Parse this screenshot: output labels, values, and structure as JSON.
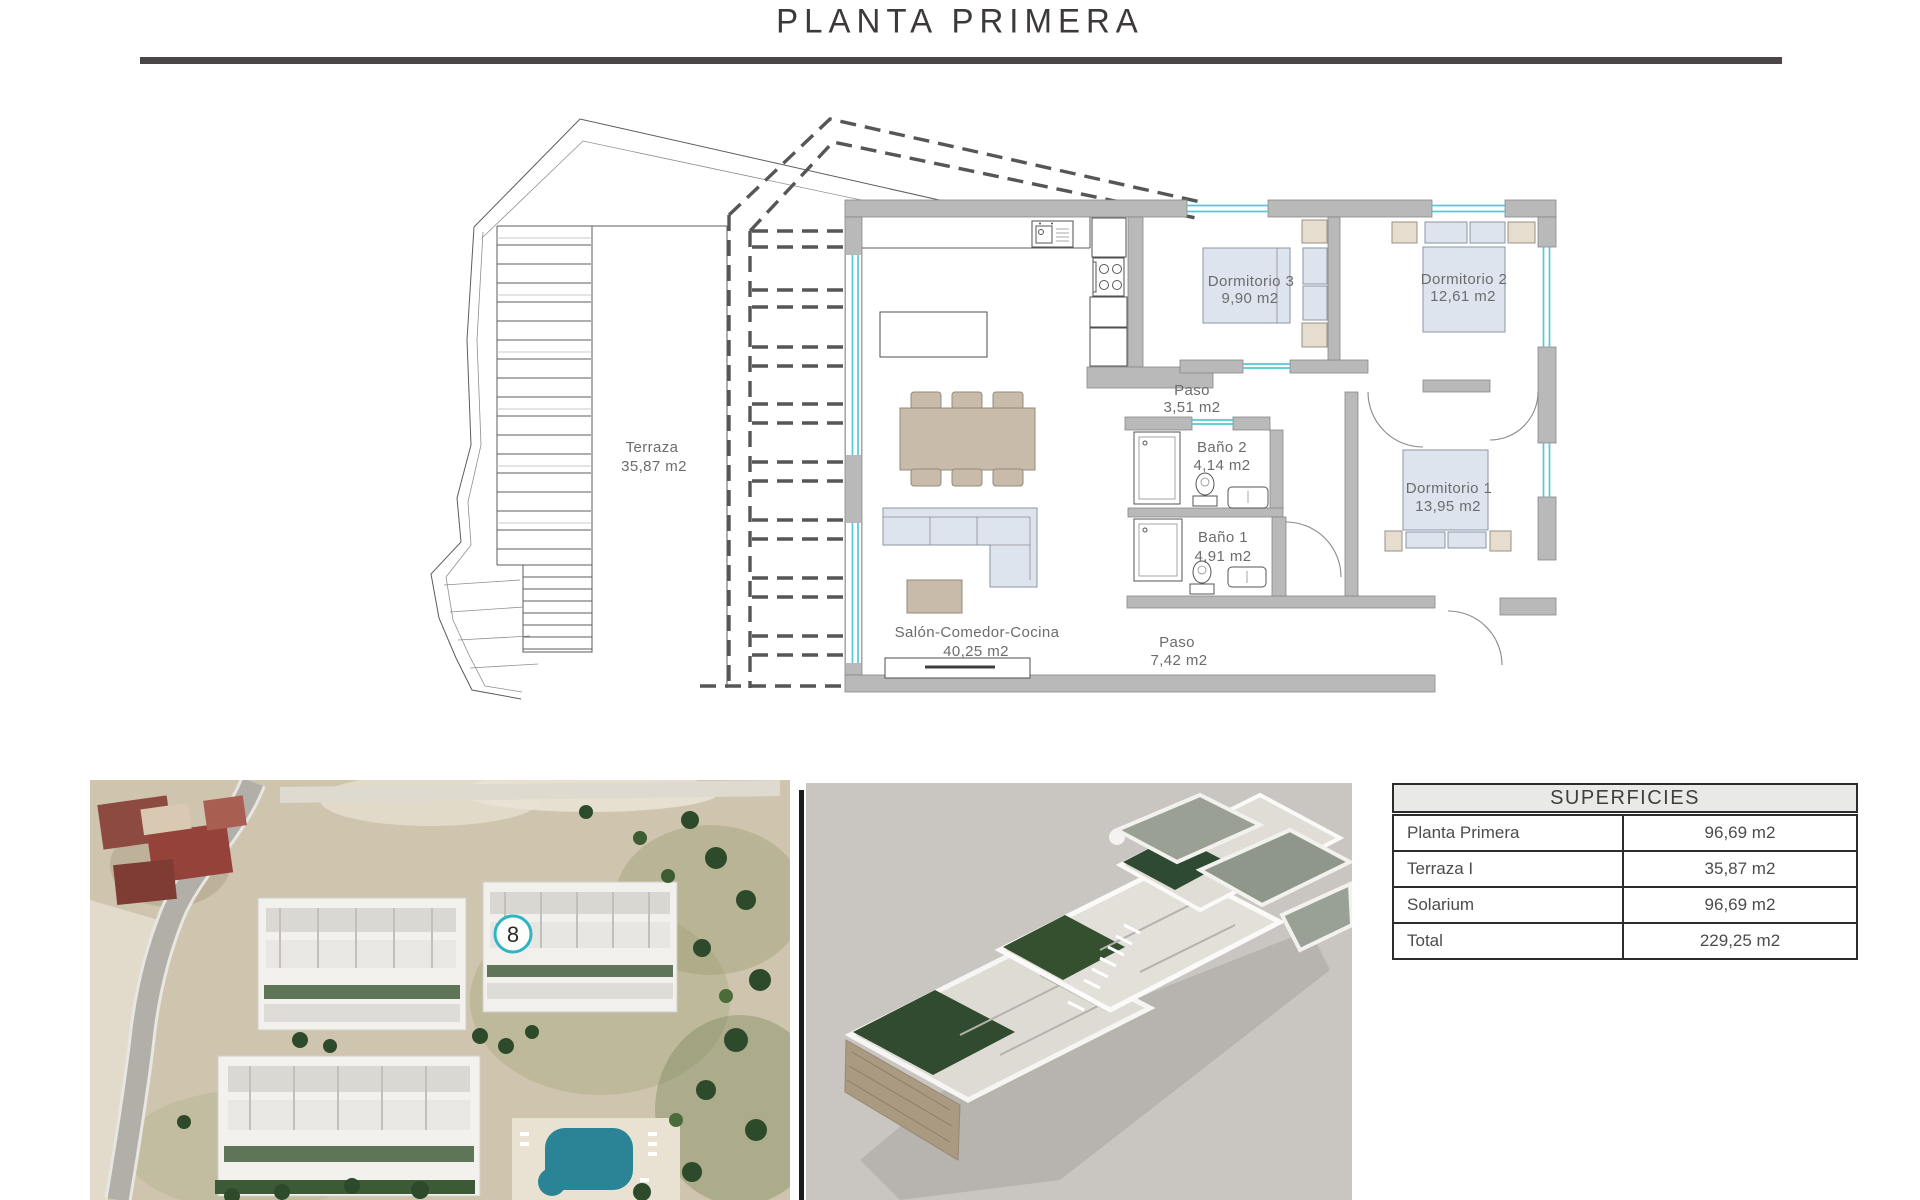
{
  "title": "PLANTA PRIMERA",
  "plan": {
    "rooms": [
      {
        "name": "Terraza",
        "area": "35,87 m2"
      },
      {
        "name": "Salón-Comedor-Cocina",
        "area": "40,25 m2"
      },
      {
        "name": "Paso",
        "area": "3,51 m2"
      },
      {
        "name": "Baño 2",
        "area": "4,14 m2"
      },
      {
        "name": "Baño 1",
        "area": "4,91 m2"
      },
      {
        "name": "Dormitorio 3",
        "area": "9,90 m2"
      },
      {
        "name": "Dormitorio 2",
        "area": "12,61 m2"
      },
      {
        "name": "Dormitorio 1",
        "area": "13,95 m2"
      },
      {
        "name": "Paso",
        "area": "7,42 m2"
      }
    ]
  },
  "site_plan": {
    "unit_marker": "8"
  },
  "table": {
    "header": "SUPERFICIES",
    "rows": [
      {
        "label": "Planta Primera",
        "value": "96,69 m2"
      },
      {
        "label": "Terraza I",
        "value": "35,87 m2"
      },
      {
        "label": "Solarium",
        "value": "96,69 m2"
      },
      {
        "label": "Total",
        "value": "229,25 m2"
      }
    ]
  },
  "colors": {
    "teal_window": "#54c8d6",
    "wall_gray": "#b9b9b9",
    "badge_teal": "#2fb4c4",
    "pool_teal": "#2a8496",
    "title_rule": "#4a4547"
  }
}
